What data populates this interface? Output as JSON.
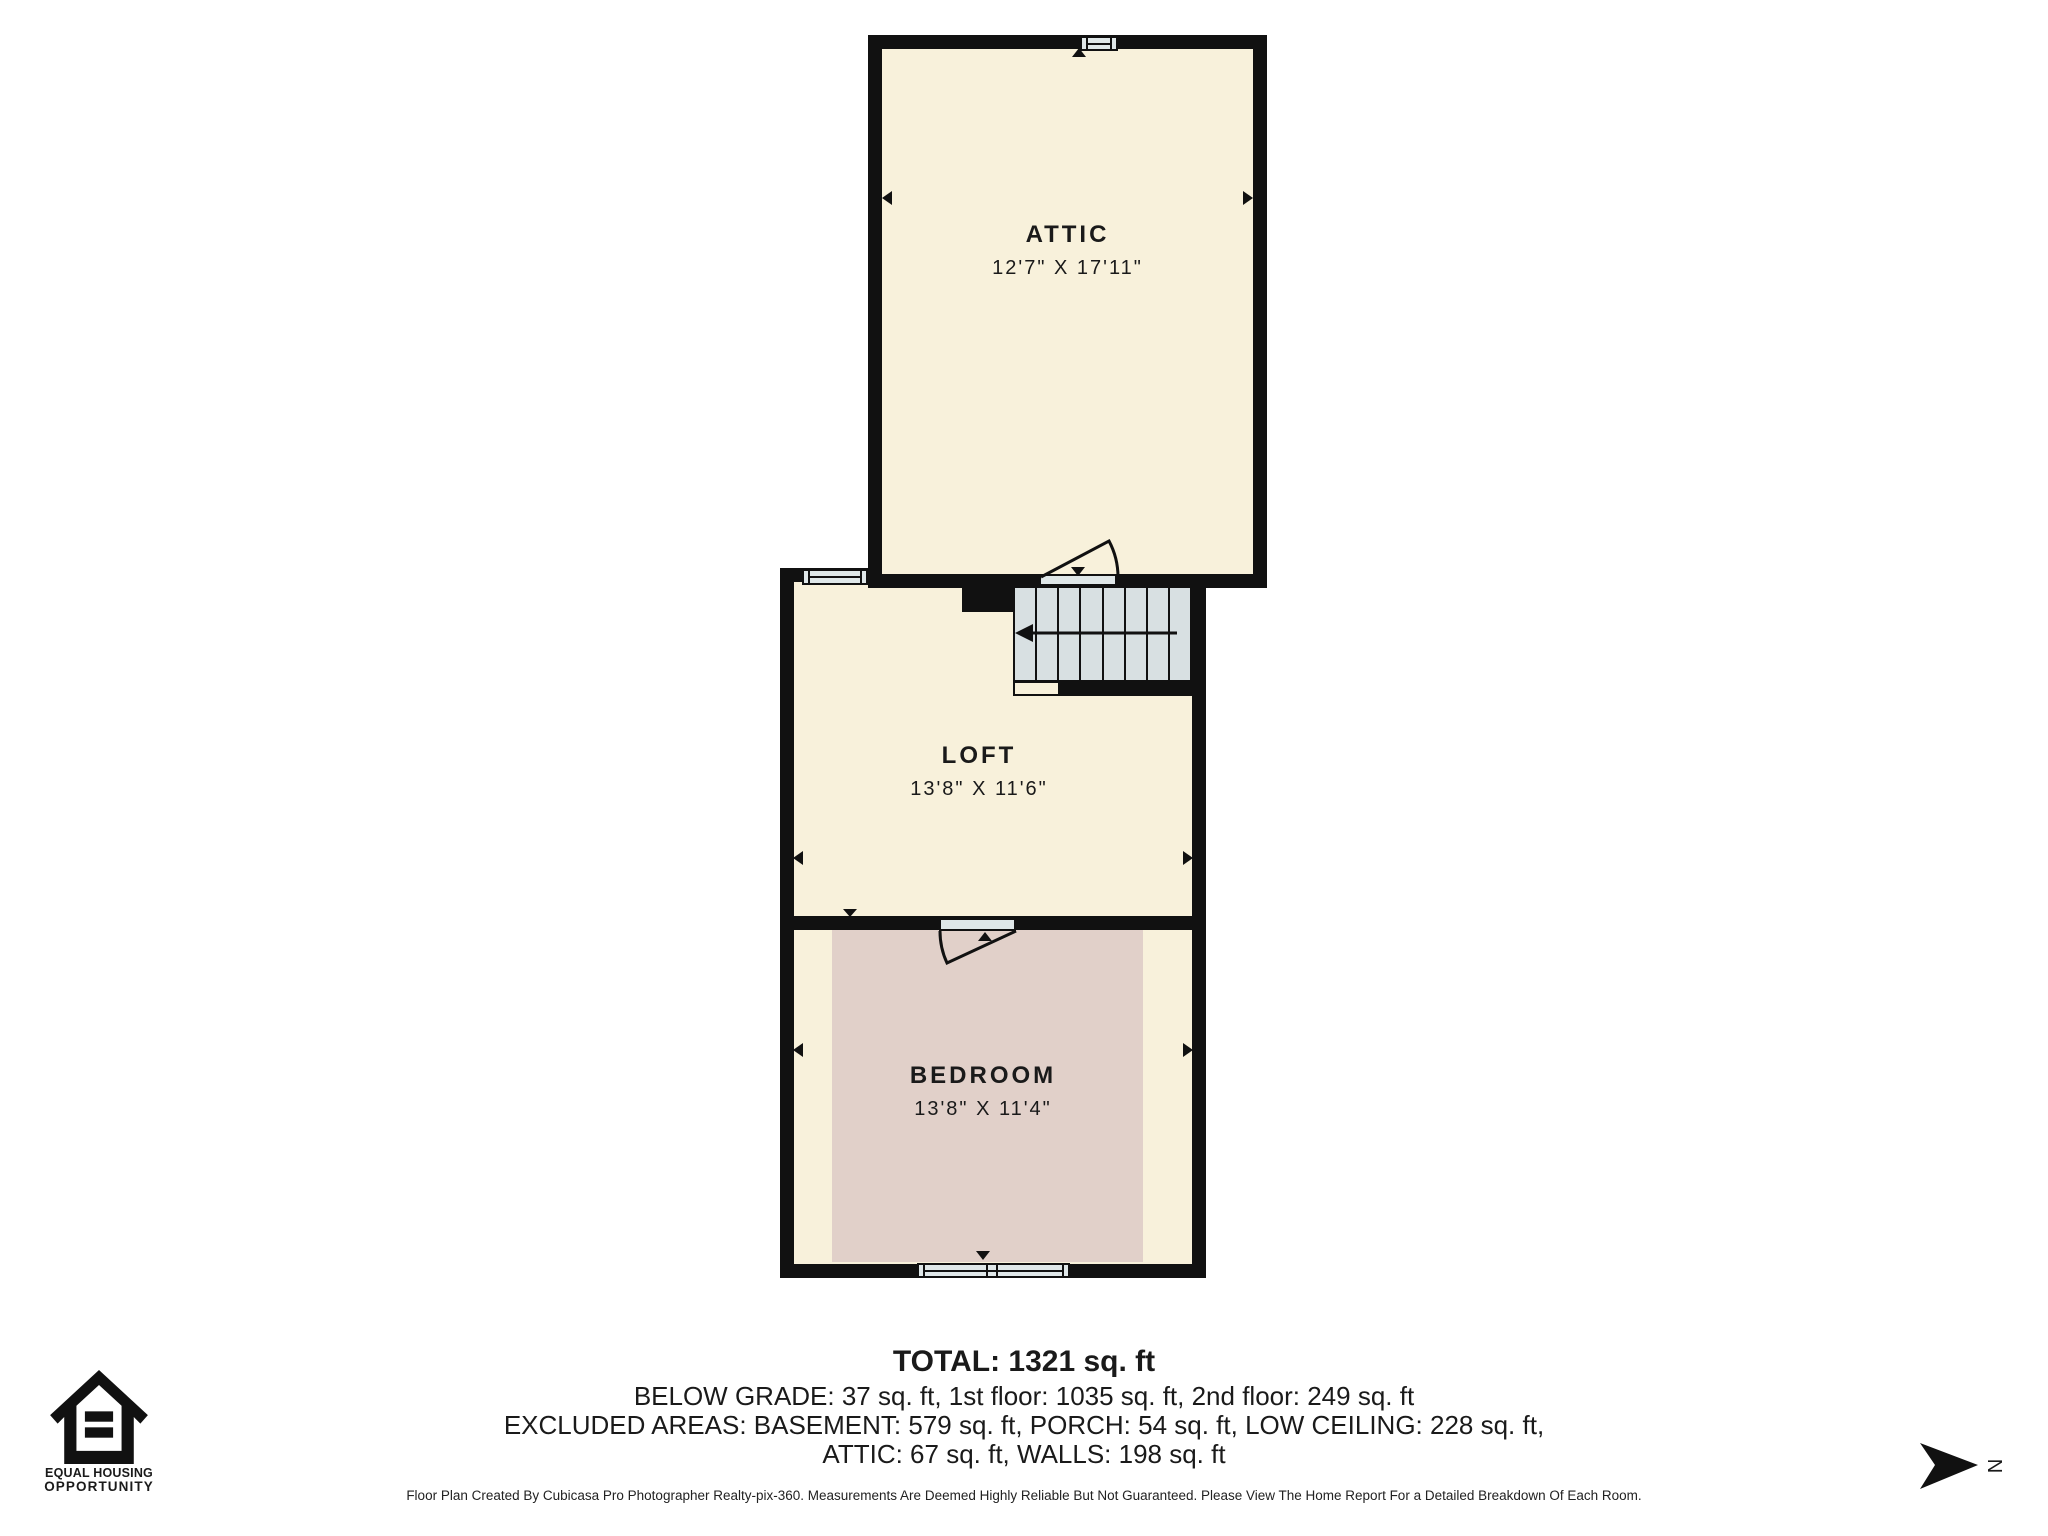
{
  "plan": {
    "rooms": {
      "attic": {
        "name": "ATTIC",
        "dims": "12'7\" X 17'11\""
      },
      "loft": {
        "name": "LOFT",
        "dims": "13'8\" X 11'6\""
      },
      "bedroom": {
        "name": "BEDROOM",
        "dims": "13'8\" X 11'4\""
      }
    },
    "compass": {
      "label": "N"
    }
  },
  "summary": {
    "total": "TOTAL: 1321 sq. ft",
    "line2": "BELOW GRADE: 37 sq. ft, 1st floor: 1035 sq. ft, 2nd floor: 249 sq. ft",
    "line3": "EXCLUDED AREAS: BASEMENT: 579 sq. ft, PORCH: 54 sq. ft, LOW CEILING: 228 sq. ft,",
    "line4": "ATTIC: 67 sq. ft, WALLS: 198 sq. ft"
  },
  "footer": {
    "disclaimer": "Floor Plan Created By Cubicasa Pro Photographer Realty-pix-360. Measurements Are Deemed Highly Reliable But Not Guaranteed. Please View The Home Report For a Detailed Breakdown Of Each Room."
  },
  "eho": {
    "line1": "EQUAL HOUSING",
    "line2": "OPPORTUNITY"
  },
  "colors": {
    "wall": "#111111",
    "floor": "#F8F1DB",
    "low_ceiling": "#E1D0C9",
    "stairs": "#D8E0E2",
    "fixture": "#DFE7E8"
  }
}
